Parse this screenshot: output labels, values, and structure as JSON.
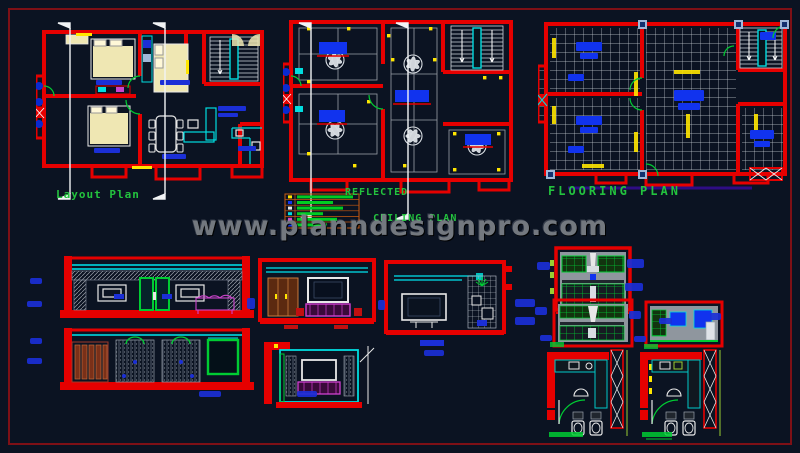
{
  "page": {
    "background_color": "#0b1322",
    "frame_color": "#7e1016",
    "description": "CAD sheet with house layout plan, reflected ceiling plan, flooring plan, wall elevations and kitchen details"
  },
  "watermark": {
    "text": "www.planndesignpro.com",
    "color": "#73787f"
  },
  "titles": {
    "layout_plan": "Layout Plan",
    "ceiling_plan_line1": "REFLECTED",
    "ceiling_plan_line2": "CEILING PLAN",
    "flooring_plan": "FLOORING PLAN",
    "title_color": "#23c33e"
  },
  "palette": {
    "wall_red": "#e60000",
    "furniture_cyan": "#00dde0",
    "bed_khaki": "#efe7b3",
    "note_blue": "#1b2fd6",
    "accent_yellow": "#ffe600",
    "accent_magenta": "#cc44cc",
    "door_green": "#00cc33",
    "wood_brown": "#7a3018",
    "tile_white": "#cfd6dd",
    "legend_orange": "#c85a10"
  },
  "drawings": [
    {
      "id": "layout-plan",
      "title": "Layout Plan"
    },
    {
      "id": "reflected-ceiling-plan",
      "title": "REFLECTED CEILING PLAN"
    },
    {
      "id": "flooring-plan",
      "title": "FLOORING PLAN"
    },
    {
      "id": "front-elevation-1"
    },
    {
      "id": "front-elevation-2"
    },
    {
      "id": "tv-unit-elevation-1"
    },
    {
      "id": "tv-unit-elevation-2"
    },
    {
      "id": "wall-elevation"
    },
    {
      "id": "kitchen-elevation-1"
    },
    {
      "id": "kitchen-elevation-2"
    },
    {
      "id": "kitchen-elevation-3"
    },
    {
      "id": "kitchen-plan-1"
    },
    {
      "id": "kitchen-plan-2"
    }
  ]
}
